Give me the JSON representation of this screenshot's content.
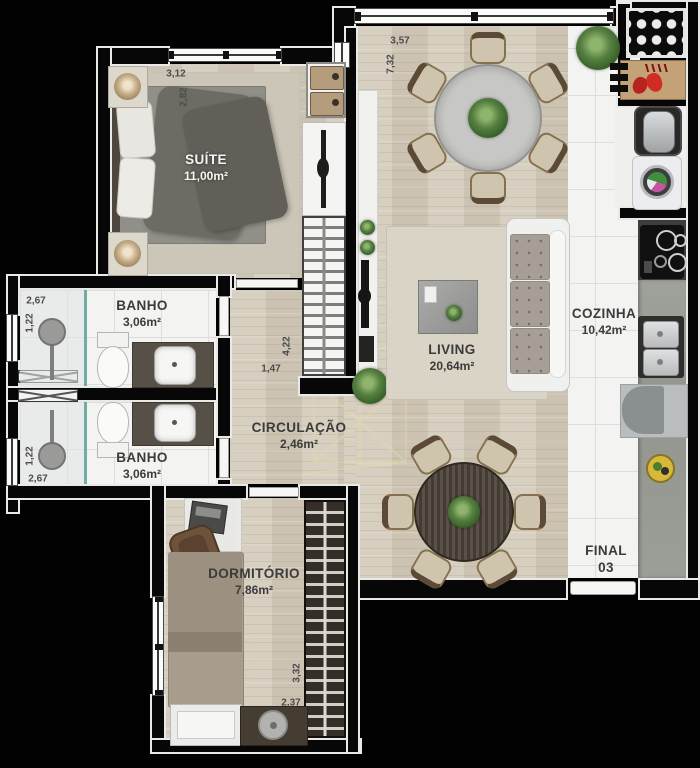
{
  "plan": {
    "rooms": {
      "suite": {
        "name": "SUÍTE",
        "area": "11,00m²"
      },
      "banho1": {
        "name": "BANHO",
        "area": "3,06m²"
      },
      "banho2": {
        "name": "BANHO",
        "area": "3,06m²"
      },
      "circulacao": {
        "name": "CIRCULAÇÃO",
        "area": "2,46m²"
      },
      "living": {
        "name": "LIVING",
        "area": "20,64m²"
      },
      "cozinha": {
        "name": "COZINHA",
        "area": "10,42m²"
      },
      "dormitorio": {
        "name": "DORMITÓRIO",
        "area": "7,86m²"
      }
    },
    "unit": {
      "line1": "FINAL",
      "line2": "03"
    },
    "dimensions": {
      "suite_width": "3,12",
      "suite_height": "2,82",
      "living_width": "3,57",
      "living_height": "7,32",
      "banho1_width": "2,67",
      "banho1_height": "1,22",
      "banho2_height": "1,22",
      "banho2_width": "2,67",
      "closet_height": "4,22",
      "closet_width": "1,47",
      "dormitorio_height": "3,32",
      "dormitorio_width": "2,37"
    },
    "colors": {
      "background": "#000000",
      "wall_outline": "#e9e9e7",
      "wood_floor": "#d5ccbc",
      "tile_floor": "#f3f3f2",
      "counter_granite": "#9b9e97",
      "watermark": "#e6dca6"
    }
  }
}
